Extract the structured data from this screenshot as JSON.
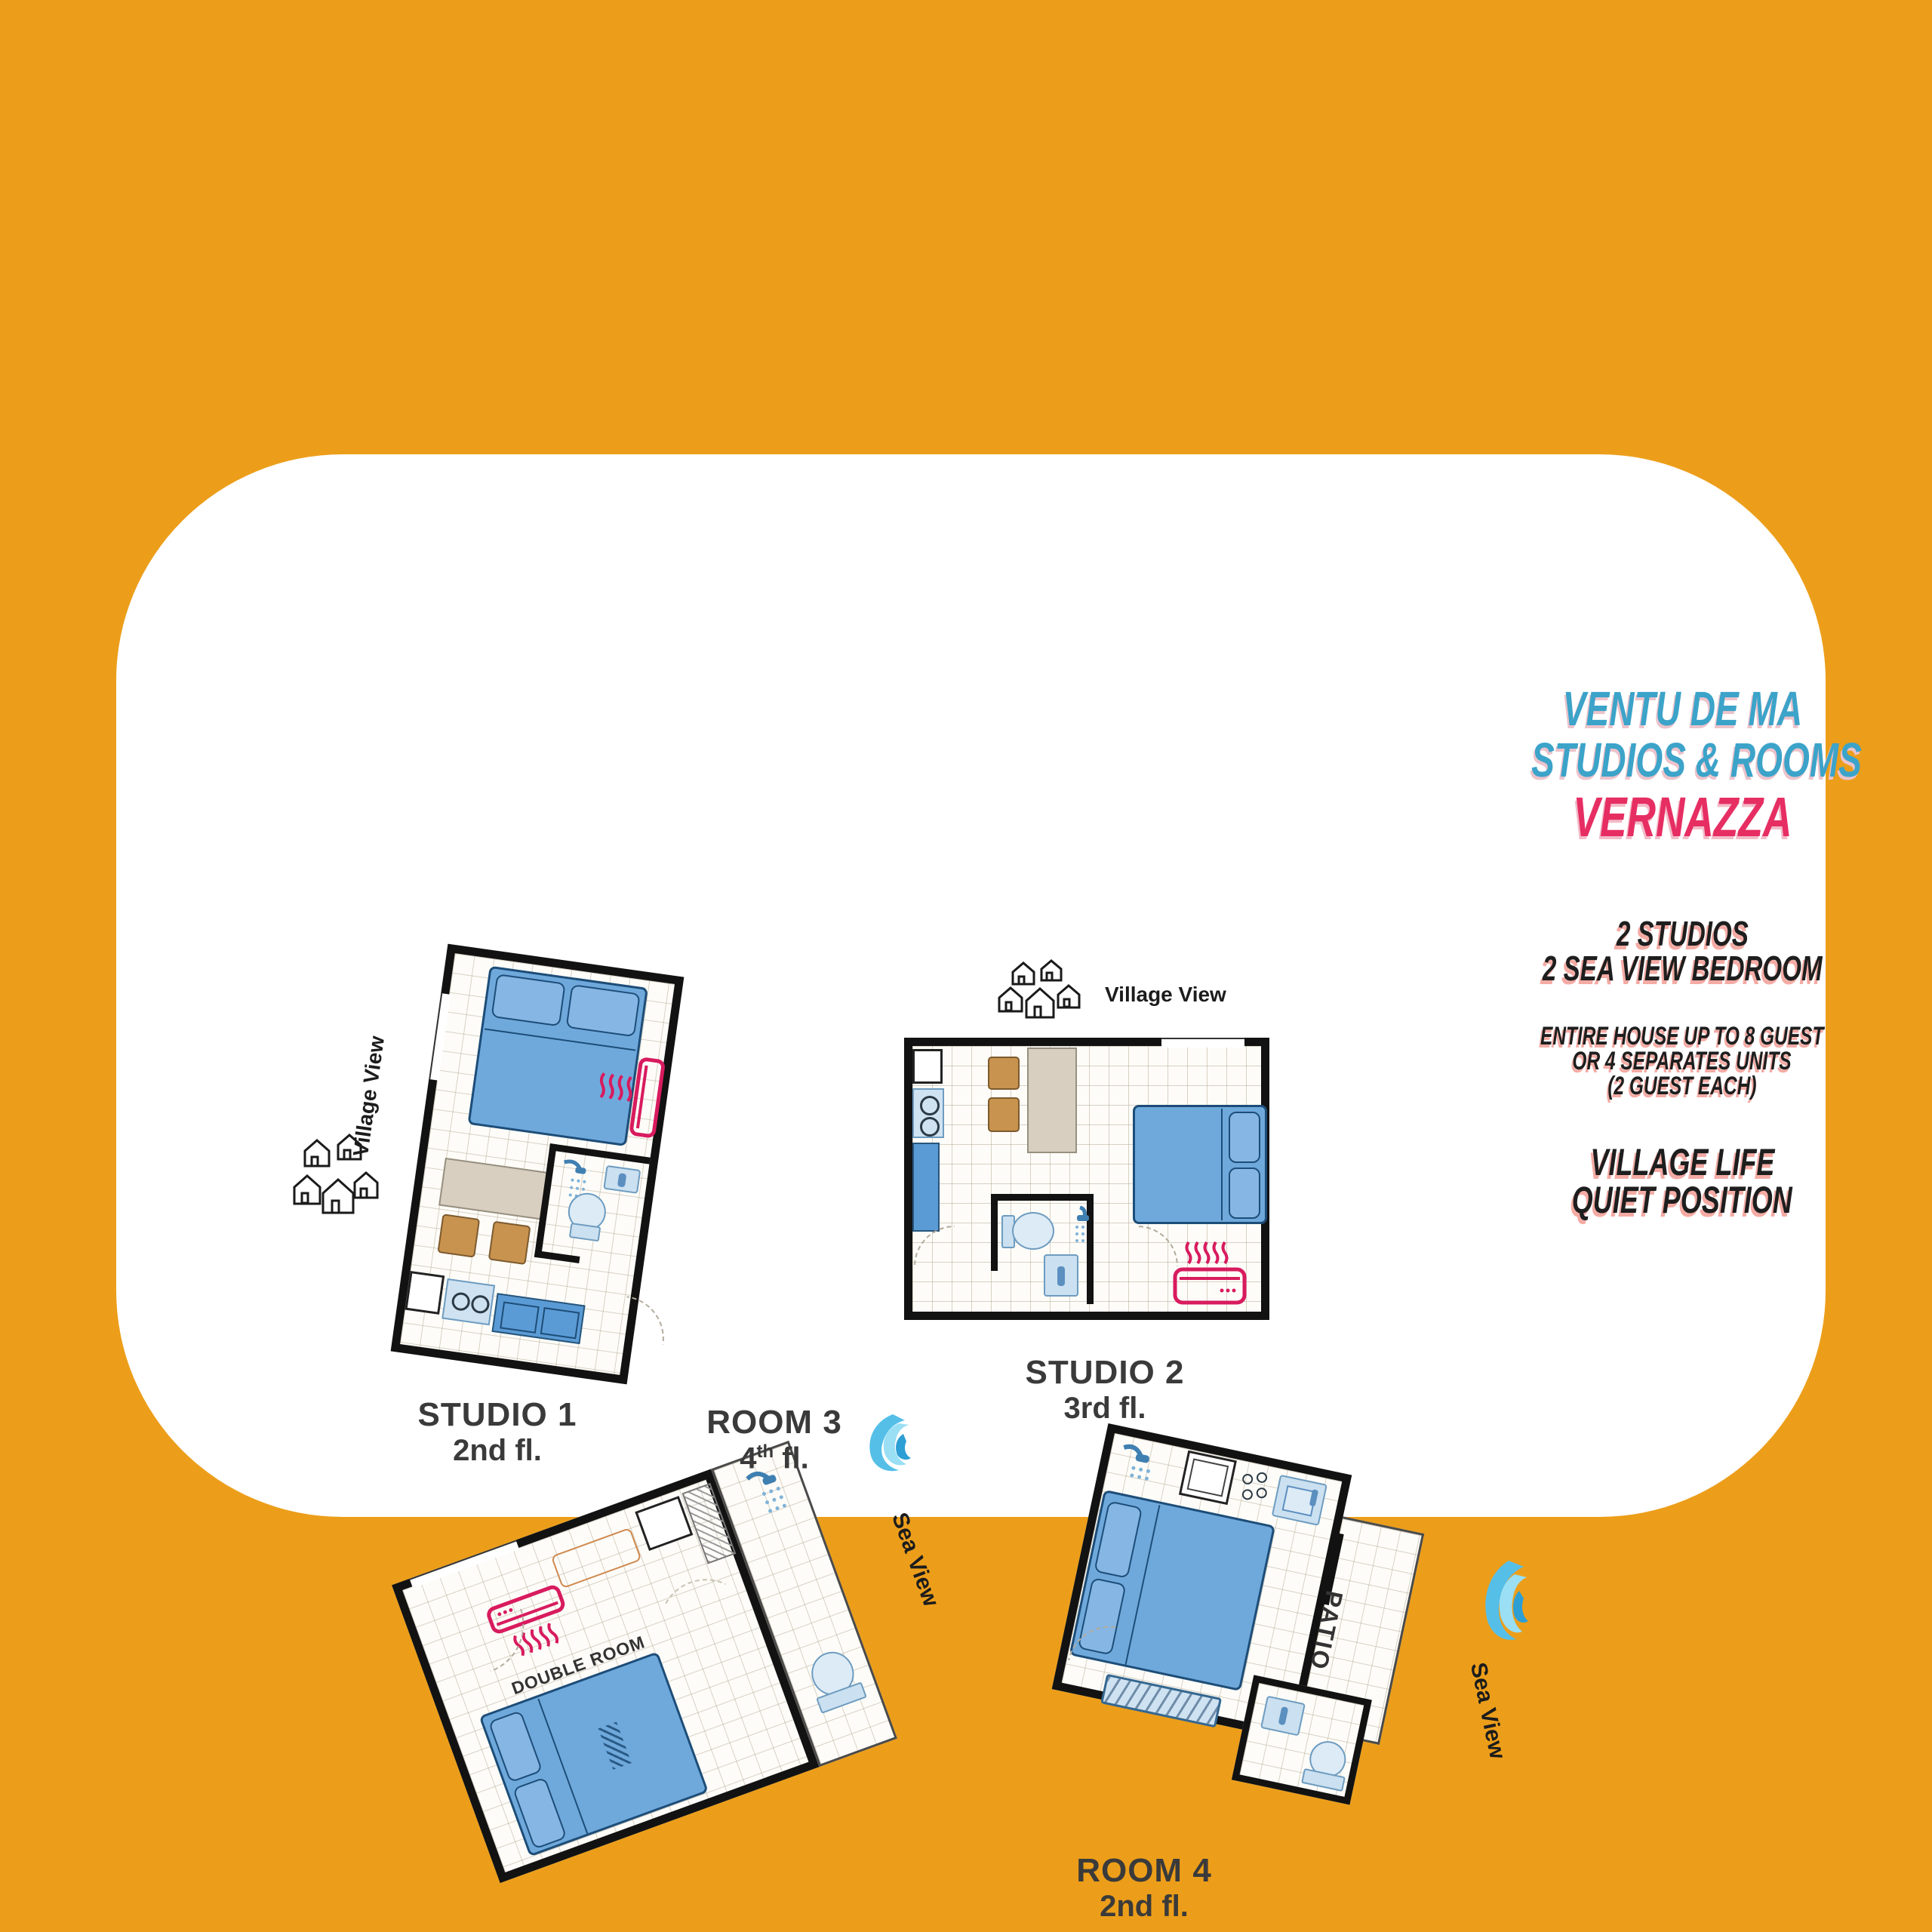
{
  "title": {
    "line1": "VENTU DE MA",
    "line2": "STUDIOS & ROOMS",
    "line3": "VERNAZZA"
  },
  "info": {
    "studios": "2 STUDIOS",
    "bedrooms": "2 SEA VIEW BEDROOM",
    "house1": "ENTIRE HOUSE UP TO 8 GUEST",
    "house2": "OR 4 SEPARATES UNITS",
    "house3": "(2 GUEST EACH)",
    "village1": "VILLAGE LIFE",
    "village2": "QUIET POSITION"
  },
  "units": [
    {
      "name": "STUDIO 1",
      "floor": "2nd fl.",
      "view": "Village View"
    },
    {
      "name": "STUDIO 2",
      "floor": "3rd fl.",
      "view": "Village View"
    },
    {
      "name": "ROOM 3",
      "floor_num": "4",
      "floor_sup": "th",
      "floor_rest": " fl.",
      "view": "Sea View",
      "interior_label": "DOUBLE ROOM"
    },
    {
      "name": "ROOM 4",
      "floor": "2nd fl.",
      "view": "Sea View",
      "patio_label": "PATIO"
    }
  ],
  "colors": {
    "background": "#EC9E1A",
    "panel": "#FFFFFF",
    "title_cyan": "#3CA3C9",
    "title_pink": "#E62E63",
    "text_shadow": "#F4ABA4",
    "wall": "#121212",
    "bed_blue": "#6FA9DC",
    "fixture_blue": "#CBE0F0",
    "counter_blue": "#5B9BD5",
    "table_tan": "#D9CFC1",
    "chair_brown": "#C8934F",
    "accent_pink": "#D81B5E",
    "wave_blue": "#49B7E4"
  }
}
